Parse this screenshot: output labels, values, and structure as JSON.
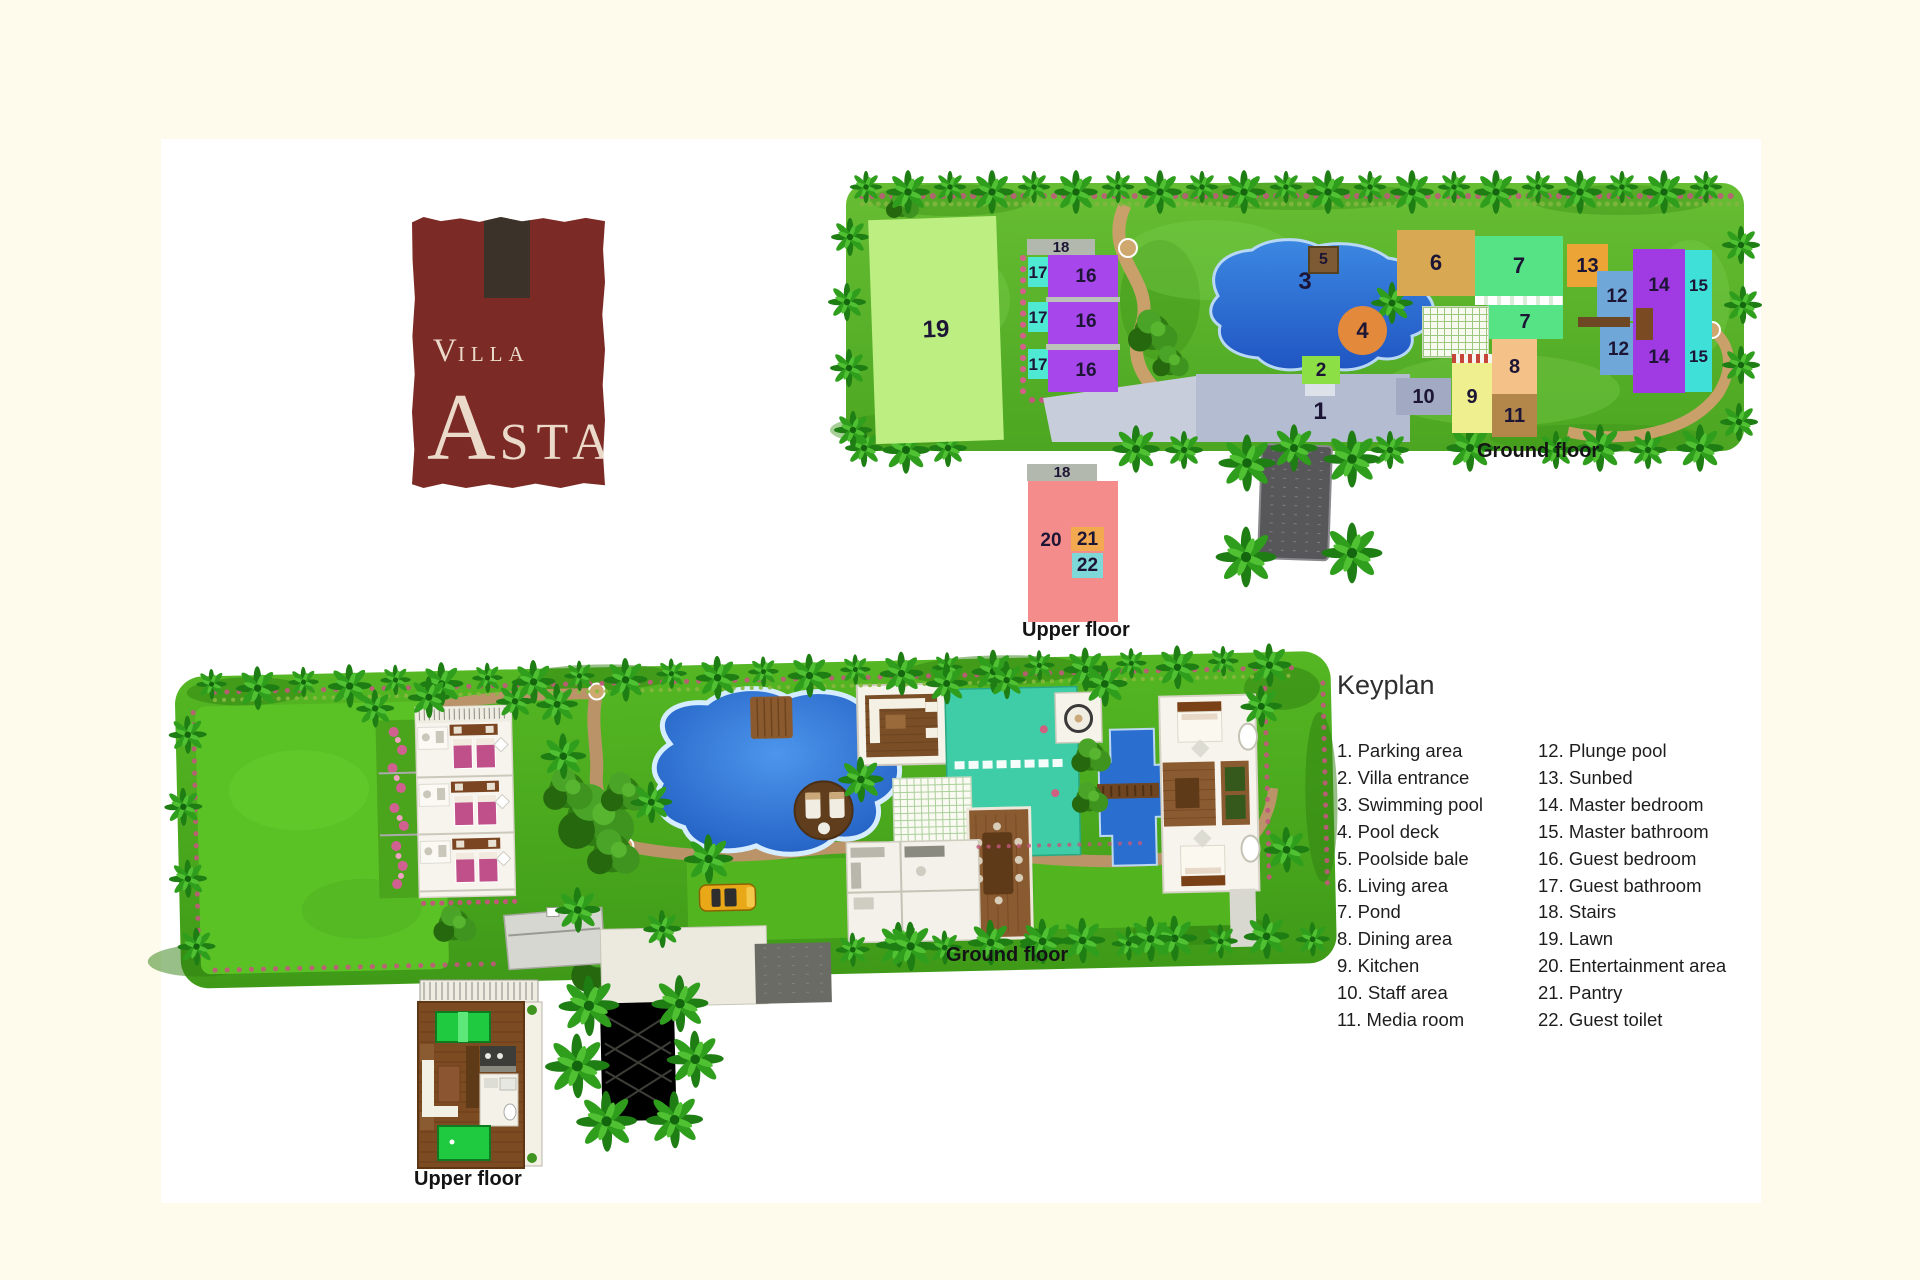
{
  "page": {
    "background": "#FFFBEC",
    "panel_background": "#FFFFFF"
  },
  "logo": {
    "v": "V",
    "illa": "ILLA",
    "a": "A",
    "sta": "STA",
    "bg": "#7C2A25",
    "block_color": "#3B332A",
    "text_color": "#EBDACA"
  },
  "captions": {
    "ground_floor": "Ground floor",
    "upper_floor": "Upper floor"
  },
  "legend": {
    "title": "Keyplan",
    "columns": [
      [
        {
          "n": 1,
          "label": "Parking area"
        },
        {
          "n": 2,
          "label": "Villa entrance"
        },
        {
          "n": 3,
          "label": "Swimming pool"
        },
        {
          "n": 4,
          "label": "Pool deck"
        },
        {
          "n": 5,
          "label": "Poolside bale"
        },
        {
          "n": 6,
          "label": "Living area"
        },
        {
          "n": 7,
          "label": "Pond"
        },
        {
          "n": 8,
          "label": "Dining area"
        },
        {
          "n": 9,
          "label": "Kitchen"
        },
        {
          "n": 10,
          "label": "Staff area"
        },
        {
          "n": 11,
          "label": "Media room"
        }
      ],
      [
        {
          "n": 12,
          "label": "Plunge pool"
        },
        {
          "n": 13,
          "label": "Sunbed"
        },
        {
          "n": 14,
          "label": "Master bedroom"
        },
        {
          "n": 15,
          "label": "Master bathroom"
        },
        {
          "n": 16,
          "label": "Guest bedroom"
        },
        {
          "n": 17,
          "label": "Guest bathroom"
        },
        {
          "n": 18,
          "label": "Stairs"
        },
        {
          "n": 19,
          "label": "Lawn"
        },
        {
          "n": 20,
          "label": "Entertainment area"
        },
        {
          "n": 21,
          "label": "Pantry"
        },
        {
          "n": 22,
          "label": "Guest toilet"
        }
      ]
    ]
  },
  "plan_areas": [
    {
      "n": "19",
      "name": "lawn-19",
      "x": 872,
      "y": 218,
      "w": 128,
      "h": 224,
      "bg": "#BCEE82",
      "fs": 24,
      "rot": -2
    },
    {
      "n": "18",
      "name": "stairs-18-ground",
      "x": 1027,
      "y": 239,
      "w": 68,
      "h": 16,
      "bg": "#B2B8AE",
      "fs": 15
    },
    {
      "n": "17",
      "name": "guest-bathroom-17-1",
      "x": 1028,
      "y": 257,
      "w": 20,
      "h": 30,
      "bg": "#4FE8D2",
      "fs": 17
    },
    {
      "n": "17",
      "name": "guest-bathroom-17-2",
      "x": 1028,
      "y": 302,
      "w": 20,
      "h": 30,
      "bg": "#4FE8D2",
      "fs": 17
    },
    {
      "n": "17",
      "name": "guest-bathroom-17-3",
      "x": 1028,
      "y": 349,
      "w": 20,
      "h": 30,
      "bg": "#4FE8D2",
      "fs": 17
    },
    {
      "n": "",
      "name": "guest-bedroom-16-block",
      "x": 1048,
      "y": 255,
      "w": 70,
      "h": 137,
      "bg": "#A746EA"
    },
    {
      "n": "16",
      "name": "guest-bedroom-16-1",
      "x": 1056,
      "y": 258,
      "w": 60,
      "h": 36,
      "bg": "transparent",
      "fs": 19
    },
    {
      "n": "16",
      "name": "guest-bedroom-16-2",
      "x": 1056,
      "y": 303,
      "w": 60,
      "h": 36,
      "bg": "transparent",
      "fs": 19
    },
    {
      "n": "16",
      "name": "guest-bedroom-16-3",
      "x": 1056,
      "y": 350,
      "w": 60,
      "h": 40,
      "bg": "transparent",
      "fs": 19
    },
    {
      "n": "",
      "name": "stair-strip-1",
      "x": 1046,
      "y": 297,
      "w": 74,
      "h": 5,
      "bg": "#BCC2BA"
    },
    {
      "n": "",
      "name": "stair-strip-2",
      "x": 1046,
      "y": 344,
      "w": 74,
      "h": 6,
      "bg": "#BCC2BA"
    },
    {
      "n": "3",
      "name": "swimming-pool-label",
      "x": 1285,
      "y": 266,
      "w": 40,
      "h": 32,
      "bg": "transparent",
      "fs": 24
    },
    {
      "n": "5",
      "name": "poolside-bale-5",
      "x": 1308,
      "y": 246,
      "w": 27,
      "h": 24,
      "bg": "#7D5A33",
      "fs": 16,
      "border": "2px solid #55401F"
    },
    {
      "n": "4",
      "name": "pool-deck-4",
      "x": 1338,
      "y": 306,
      "w": 49,
      "h": 49,
      "bg": "#E2893B",
      "fs": 22,
      "round": true
    },
    {
      "n": "2",
      "name": "villa-entrance-2",
      "x": 1302,
      "y": 356,
      "w": 38,
      "h": 28,
      "bg": "#8CDF44",
      "fs": 19
    },
    {
      "n": "1",
      "name": "parking-area-label",
      "x": 1300,
      "y": 396,
      "w": 40,
      "h": 32,
      "bg": "transparent",
      "fs": 24
    },
    {
      "n": "10",
      "name": "staff-area-10",
      "x": 1396,
      "y": 378,
      "w": 55,
      "h": 37,
      "bg": "#A2A9C2",
      "fs": 20
    },
    {
      "n": "6",
      "name": "living-area-6",
      "x": 1397,
      "y": 230,
      "w": 78,
      "h": 66,
      "bg": "#D8A952",
      "fs": 22
    },
    {
      "n": "7",
      "name": "pond-7-upper",
      "x": 1475,
      "y": 236,
      "w": 88,
      "h": 60,
      "bg": "#56E385",
      "fs": 22
    },
    {
      "n": "",
      "name": "pond-divider",
      "x": 1475,
      "y": 296,
      "w": 88,
      "h": 9,
      "cls": "dash-white"
    },
    {
      "n": "7",
      "name": "pond-7-lower",
      "x": 1487,
      "y": 305,
      "w": 76,
      "h": 34,
      "bg": "#56E385",
      "fs": 20
    },
    {
      "n": "",
      "name": "pool-deck-grid",
      "x": 1422,
      "y": 306,
      "w": 65,
      "h": 50,
      "cls": "grid-green"
    },
    {
      "n": "8",
      "name": "dining-area-8",
      "x": 1492,
      "y": 339,
      "w": 45,
      "h": 55,
      "bg": "#F4C189",
      "fs": 20
    },
    {
      "n": "9",
      "name": "kitchen-9",
      "x": 1452,
      "y": 361,
      "w": 40,
      "h": 72,
      "bg": "#EFEF90",
      "fs": 20
    },
    {
      "n": "",
      "name": "checker-strip",
      "x": 1452,
      "y": 354,
      "w": 40,
      "h": 9,
      "cls": "checker-red"
    },
    {
      "n": "11",
      "name": "media-room-11",
      "x": 1492,
      "y": 394,
      "w": 45,
      "h": 43,
      "bg": "#B28749",
      "fs": 20
    },
    {
      "n": "13",
      "name": "sunbed-13",
      "x": 1567,
      "y": 244,
      "w": 41,
      "h": 43,
      "bg": "#EDA437",
      "fs": 20
    },
    {
      "n": "12",
      "name": "plunge-pool-12-upper",
      "x": 1597,
      "y": 271,
      "w": 40,
      "h": 50,
      "bg": "#6FA8D8",
      "fs": 19
    },
    {
      "n": "12",
      "name": "plunge-pool-12-lower",
      "x": 1600,
      "y": 323,
      "w": 37,
      "h": 52,
      "bg": "#6FA8D8",
      "fs": 19
    },
    {
      "n": "",
      "name": "bridge-strip",
      "x": 1578,
      "y": 317,
      "w": 52,
      "h": 10,
      "bg": "#6E4824"
    },
    {
      "n": "14",
      "name": "master-bedroom-14-upper",
      "x": 1633,
      "y": 249,
      "w": 52,
      "h": 72,
      "bg": "#A03BE4",
      "fs": 19
    },
    {
      "n": "14",
      "name": "master-bedroom-14-lower",
      "x": 1633,
      "y": 321,
      "w": 52,
      "h": 72,
      "bg": "#A03BE4",
      "fs": 19
    },
    {
      "n": "15",
      "name": "master-bathroom-15-upper",
      "x": 1685,
      "y": 250,
      "w": 27,
      "h": 71,
      "bg": "#3FE0D8",
      "fs": 17
    },
    {
      "n": "15",
      "name": "master-bathroom-15-lower",
      "x": 1685,
      "y": 321,
      "w": 27,
      "h": 71,
      "bg": "#3FE0D8",
      "fs": 17
    },
    {
      "n": "",
      "name": "sunbed-deck-shape",
      "x": 1636,
      "y": 308,
      "w": 17,
      "h": 32,
      "bg": "#7A4A22"
    },
    {
      "n": "18",
      "name": "stairs-18-upper",
      "x": 1027,
      "y": 464,
      "w": 70,
      "h": 17,
      "bg": "#B2B8AE",
      "fs": 15
    },
    {
      "n": "",
      "name": "entertainment-area-20-block",
      "x": 1028,
      "y": 481,
      "w": 90,
      "h": 141,
      "bg": "#F58C8C"
    },
    {
      "n": "20",
      "name": "entertainment-area-20-label",
      "x": 1034,
      "y": 528,
      "w": 34,
      "h": 24,
      "bg": "transparent",
      "fs": 19
    },
    {
      "n": "21",
      "name": "pantry-21",
      "x": 1071,
      "y": 527,
      "w": 33,
      "h": 24,
      "bg": "#F2A94F",
      "fs": 19
    },
    {
      "n": "22",
      "name": "guest-toilet-22",
      "x": 1072,
      "y": 553,
      "w": 31,
      "h": 25,
      "bg": "#7FD8D8",
      "fs": 19
    }
  ]
}
